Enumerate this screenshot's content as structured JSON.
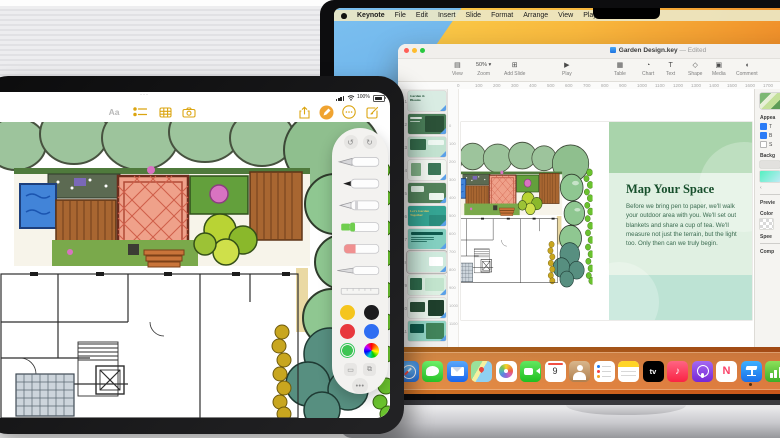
{
  "ipad": {
    "status_bar": {
      "handle": "···",
      "battery_percent": "100%"
    },
    "toolbar": {
      "format_button_label": "Aa"
    },
    "markup_palette": {
      "undo_glyph": "↺",
      "redo_glyph": "↻",
      "more_glyph": "•••",
      "tools": [
        "fountain-pen",
        "marker",
        "pen",
        "highlighter",
        "eraser",
        "fineliner",
        "ruler"
      ],
      "colors": [
        {
          "name": "yellow",
          "hex": "#f5c51d",
          "selected": false
        },
        {
          "name": "black",
          "hex": "#1c1c1e",
          "selected": false
        },
        {
          "name": "red",
          "hex": "#e8383d",
          "selected": false
        },
        {
          "name": "blue",
          "hex": "#2f6ef2",
          "selected": false
        },
        {
          "name": "green",
          "hex": "#3ec553",
          "selected": true
        },
        {
          "name": "multicolor",
          "hex": "conic",
          "selected": false
        }
      ]
    }
  },
  "mac": {
    "menu_bar": {
      "items": [
        "Keynote",
        "File",
        "Edit",
        "Insert",
        "Slide",
        "Format",
        "Arrange",
        "View",
        "Play",
        "Window",
        "Help"
      ]
    },
    "keynote": {
      "window_title": "Garden Design.key",
      "edited_label": "— Edited",
      "toolbar": [
        {
          "id": "view",
          "label": "View"
        },
        {
          "id": "zoom",
          "label": "Zoom",
          "value": "50%",
          "chevron": "▾"
        },
        {
          "id": "add-slide",
          "label": "Add Slide"
        },
        {
          "id": "play",
          "label": "Play"
        },
        {
          "id": "table",
          "label": "Table"
        },
        {
          "id": "chart",
          "label": "Chart"
        },
        {
          "id": "text",
          "label": "Text"
        },
        {
          "id": "shape",
          "label": "Shape"
        },
        {
          "id": "media",
          "label": "Media"
        },
        {
          "id": "comment",
          "label": "Comment"
        },
        {
          "id": "collaborate",
          "label": "Collaborate"
        }
      ],
      "ruler_values": [
        "0",
        "100",
        "200",
        "300",
        "400",
        "500",
        "600",
        "700",
        "800",
        "900",
        "1000",
        "1100",
        "1200",
        "1300",
        "1400",
        "1500",
        "1600",
        "1700"
      ],
      "vruler_values": [
        "0",
        "100",
        "200",
        "300",
        "400",
        "500",
        "600",
        "700",
        "800",
        "900",
        "1000",
        "1100"
      ],
      "navigator": {
        "slides": [
          {
            "n": "1",
            "bg": "#d9ece3",
            "title": "Garden & Blooms",
            "title_color": "#1d4f34",
            "blocks": [],
            "selected": false
          },
          {
            "n": "2",
            "bg": "#4a7d58",
            "blocks": [
              [
                46,
                8,
                48,
                84,
                "#2c5238"
              ],
              [
                6,
                16,
                32,
                10,
                "#e9f4ec"
              ],
              [
                6,
                34,
                26,
                5,
                "#c4dccb"
              ]
            ],
            "selected": false
          },
          {
            "n": "3",
            "bg": "#c2e2d0",
            "blocks": [
              [
                5,
                10,
                42,
                58,
                "#356c4c"
              ],
              [
                52,
                14,
                42,
                28,
                "#eef7f1"
              ]
            ],
            "selected": false
          },
          {
            "n": "4",
            "bg": "#f1f6f0",
            "blocks": [
              [
                8,
                14,
                26,
                68,
                "#7fae85"
              ],
              [
                52,
                16,
                36,
                58,
                "#3b7757"
              ]
            ],
            "selected": false
          },
          {
            "n": "5",
            "bg": "#53825b",
            "blocks": [
              [
                7,
                14,
                34,
                30,
                "#e2f0e5"
              ],
              [
                54,
                50,
                40,
                36,
                "#edf6ef"
              ]
            ],
            "selected": false
          },
          {
            "n": "6",
            "bg": "#35a493",
            "title": "Let's Garden Together",
            "title_color": "#e4cf6b",
            "blocks": [
              [
                55,
                45,
                45,
                55,
                "#2b8d7e"
              ]
            ],
            "selected": false
          },
          {
            "n": "7",
            "bg": "#83cfc0",
            "blocks": [
              [
                7,
                16,
                86,
                12,
                "#0f5a4e"
              ],
              [
                7,
                38,
                62,
                6,
                "#2d7a6c"
              ],
              [
                7,
                50,
                62,
                6,
                "#2d7a6c"
              ],
              [
                7,
                62,
                44,
                6,
                "#2d7a6c"
              ]
            ],
            "selected": false
          },
          {
            "n": "8",
            "bg": "#cfeadd",
            "blocks": [
              [
                54,
                22,
                38,
                50,
                "#ffffff"
              ]
            ],
            "selected": true
          },
          {
            "n": "9",
            "bg": "#ddf0e3",
            "blocks": [
              [
                6,
                14,
                30,
                64,
                "#2f6b4c"
              ],
              [
                44,
                14,
                50,
                68,
                "#c2e4cd"
              ]
            ],
            "selected": false
          },
          {
            "n": "10",
            "bg": "#e9f3eb",
            "blocks": [
              [
                6,
                18,
                40,
                54,
                "#2a4f38"
              ],
              [
                52,
                10,
                42,
                80,
                "#1f3f2c"
              ]
            ],
            "selected": false
          },
          {
            "n": "11",
            "bg": "#91d5c5",
            "blocks": [
              [
                6,
                16,
                36,
                44,
                "#0e594b"
              ],
              [
                48,
                8,
                46,
                84,
                "#41835a"
              ]
            ],
            "selected": false
          }
        ]
      },
      "slide": {
        "title": "Map Your Space",
        "body": "Before we bring pen to paper, we'll walk your outdoor area with you. We'll set out blankets and share a cup of tea. We'll measure not just the terrain, but the light too. Only then can we truly begin."
      },
      "format_panel": {
        "appearance_label": "Appea",
        "checkboxes": [
          {
            "label": "T",
            "checked": true
          },
          {
            "label": "B",
            "checked": true
          },
          {
            "label": "S",
            "checked": false
          }
        ],
        "background_label": "Backg",
        "collapse_glyph": "‹",
        "preview_label": "Previe",
        "color_label": "Color",
        "speed_label": "Spee",
        "complete_label": "Comp"
      }
    },
    "dock": {
      "items": [
        "safari",
        "messages",
        "mail",
        "maps",
        "photos",
        "facetime",
        "calendar",
        "contacts",
        "reminders",
        "notes",
        "tv",
        "music",
        "podcasts",
        "news",
        "keynote",
        "numbers"
      ],
      "active_app": "keynote",
      "calendar_day": "9",
      "tv_label": "tv",
      "news_letter": "N",
      "music_glyph": "♪"
    }
  }
}
